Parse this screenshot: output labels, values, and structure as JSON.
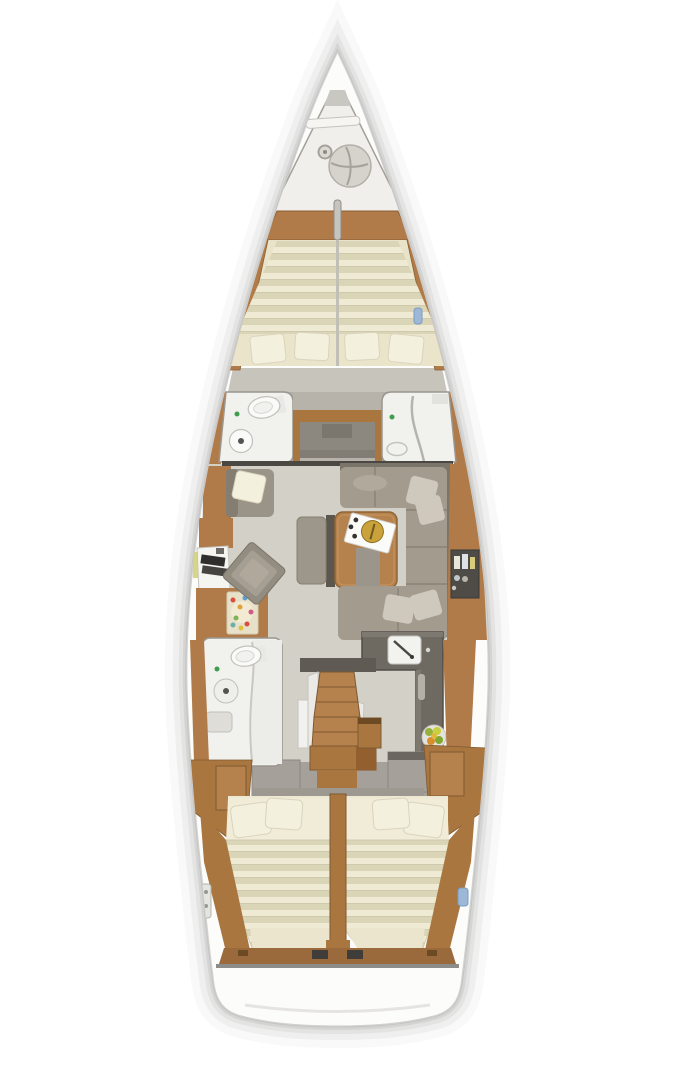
{
  "meta": {
    "kind": "sailing-yacht-interior-floorplan",
    "view": "top-down",
    "canvas": {
      "width": 675,
      "height": 1080
    }
  },
  "colors": {
    "hull": "#fcfcfb",
    "hull_line": "#d2d1ce",
    "shadow": "#8f8f8d",
    "deck": "#f0efec",
    "floor": "#d3d0c8",
    "floor_dark": "#c7c4bc",
    "wood": "#b07a49",
    "wood2": "#a9763f",
    "wood_dark": "#7e5930",
    "wood_light": "#c8965e",
    "table_wood": "#b5814d",
    "bulkhead": "#4b4844",
    "wall_gray": "#a39e96",
    "wall_gray_light": "#b7b3ab",
    "wall_line": "#9a968e",
    "recess": "#8c8880",
    "room_white": "#f1f1ee",
    "fixture": "#fafaf8",
    "fixture_line": "#c2c0ba",
    "sofa": "#a39b8e",
    "sofa_dark": "#7b7569",
    "sofa_seam": "#8a8275",
    "cushion": "#cfc9bd",
    "counter": "#6e6a62",
    "counter_edge": "#514e48",
    "cream": "#e8e3c9",
    "stripe_a": "#efead4",
    "stripe_b": "#dbd5b8",
    "stripe_line": "#cfc9ad",
    "pillow": "#f3f0de",
    "pillow_line": "#d9d4bc",
    "gold": "#c9a23c",
    "green_dot": "#3f9e4e",
    "blue_tag": "#9db8d6",
    "fruit_green": "#95b23c",
    "fruit_orange": "#d98e2b",
    "fruit_yellow": "#e0c23a",
    "rug_base": "#e7e1c9",
    "laptop_dark": "#2f2e2c"
  },
  "areas": {
    "bow": [
      "anchor-locker",
      "windlass"
    ],
    "forward_cabin": [
      "v-berth-double-bed",
      "pillows"
    ],
    "forward_heads": [
      "port-toilet-room",
      "center-passage",
      "starboard-shower-room"
    ],
    "salon": [
      "port-settee",
      "nav-desk",
      "armchair",
      "rug",
      "bench",
      "dining-table-with-tray",
      "u-shaped-sofa",
      "starboard-bottle-shelf"
    ],
    "galley": [
      "l-shaped-counter",
      "sink",
      "fruit-bowl"
    ],
    "companionway": [
      "stairs",
      "platform",
      "side-lockers"
    ],
    "aft_head": [
      "toilet",
      "sink",
      "shower"
    ],
    "aft_cabins": [
      "port-double-bed",
      "starboard-double-bed",
      "wardrobes"
    ]
  }
}
